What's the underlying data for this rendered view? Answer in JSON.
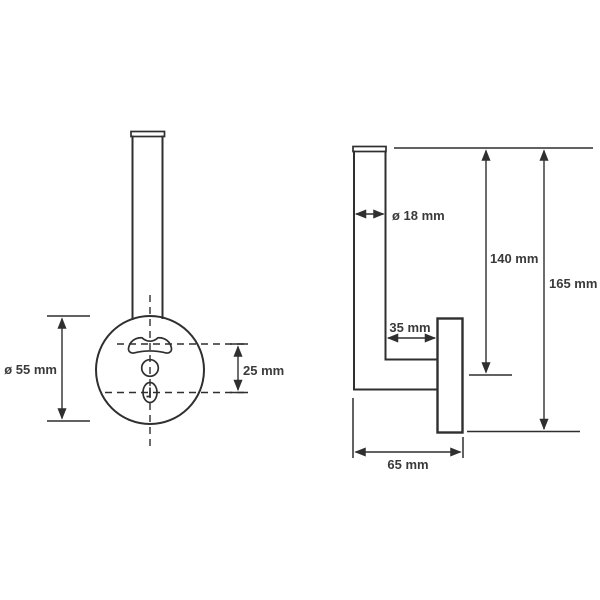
{
  "figure": {
    "type": "technical-drawing",
    "background": "#ffffff",
    "line_color": "#2f2f2f",
    "text_color": "#3a3a3a",
    "views": {
      "front": {
        "dimensions": [
          {
            "id": "plate-diameter",
            "label": "ø 55 mm"
          },
          {
            "id": "hole-offset",
            "label": "25 mm"
          }
        ]
      },
      "side": {
        "dimensions": [
          {
            "id": "tube-diameter",
            "label": "ø 18 mm"
          },
          {
            "id": "height-to-plate-center",
            "label": "140 mm"
          },
          {
            "id": "overall-height",
            "label": "165 mm"
          },
          {
            "id": "tube-to-plate-gap",
            "label": "35 mm"
          },
          {
            "id": "overall-depth",
            "label": "65 mm"
          }
        ]
      }
    }
  }
}
